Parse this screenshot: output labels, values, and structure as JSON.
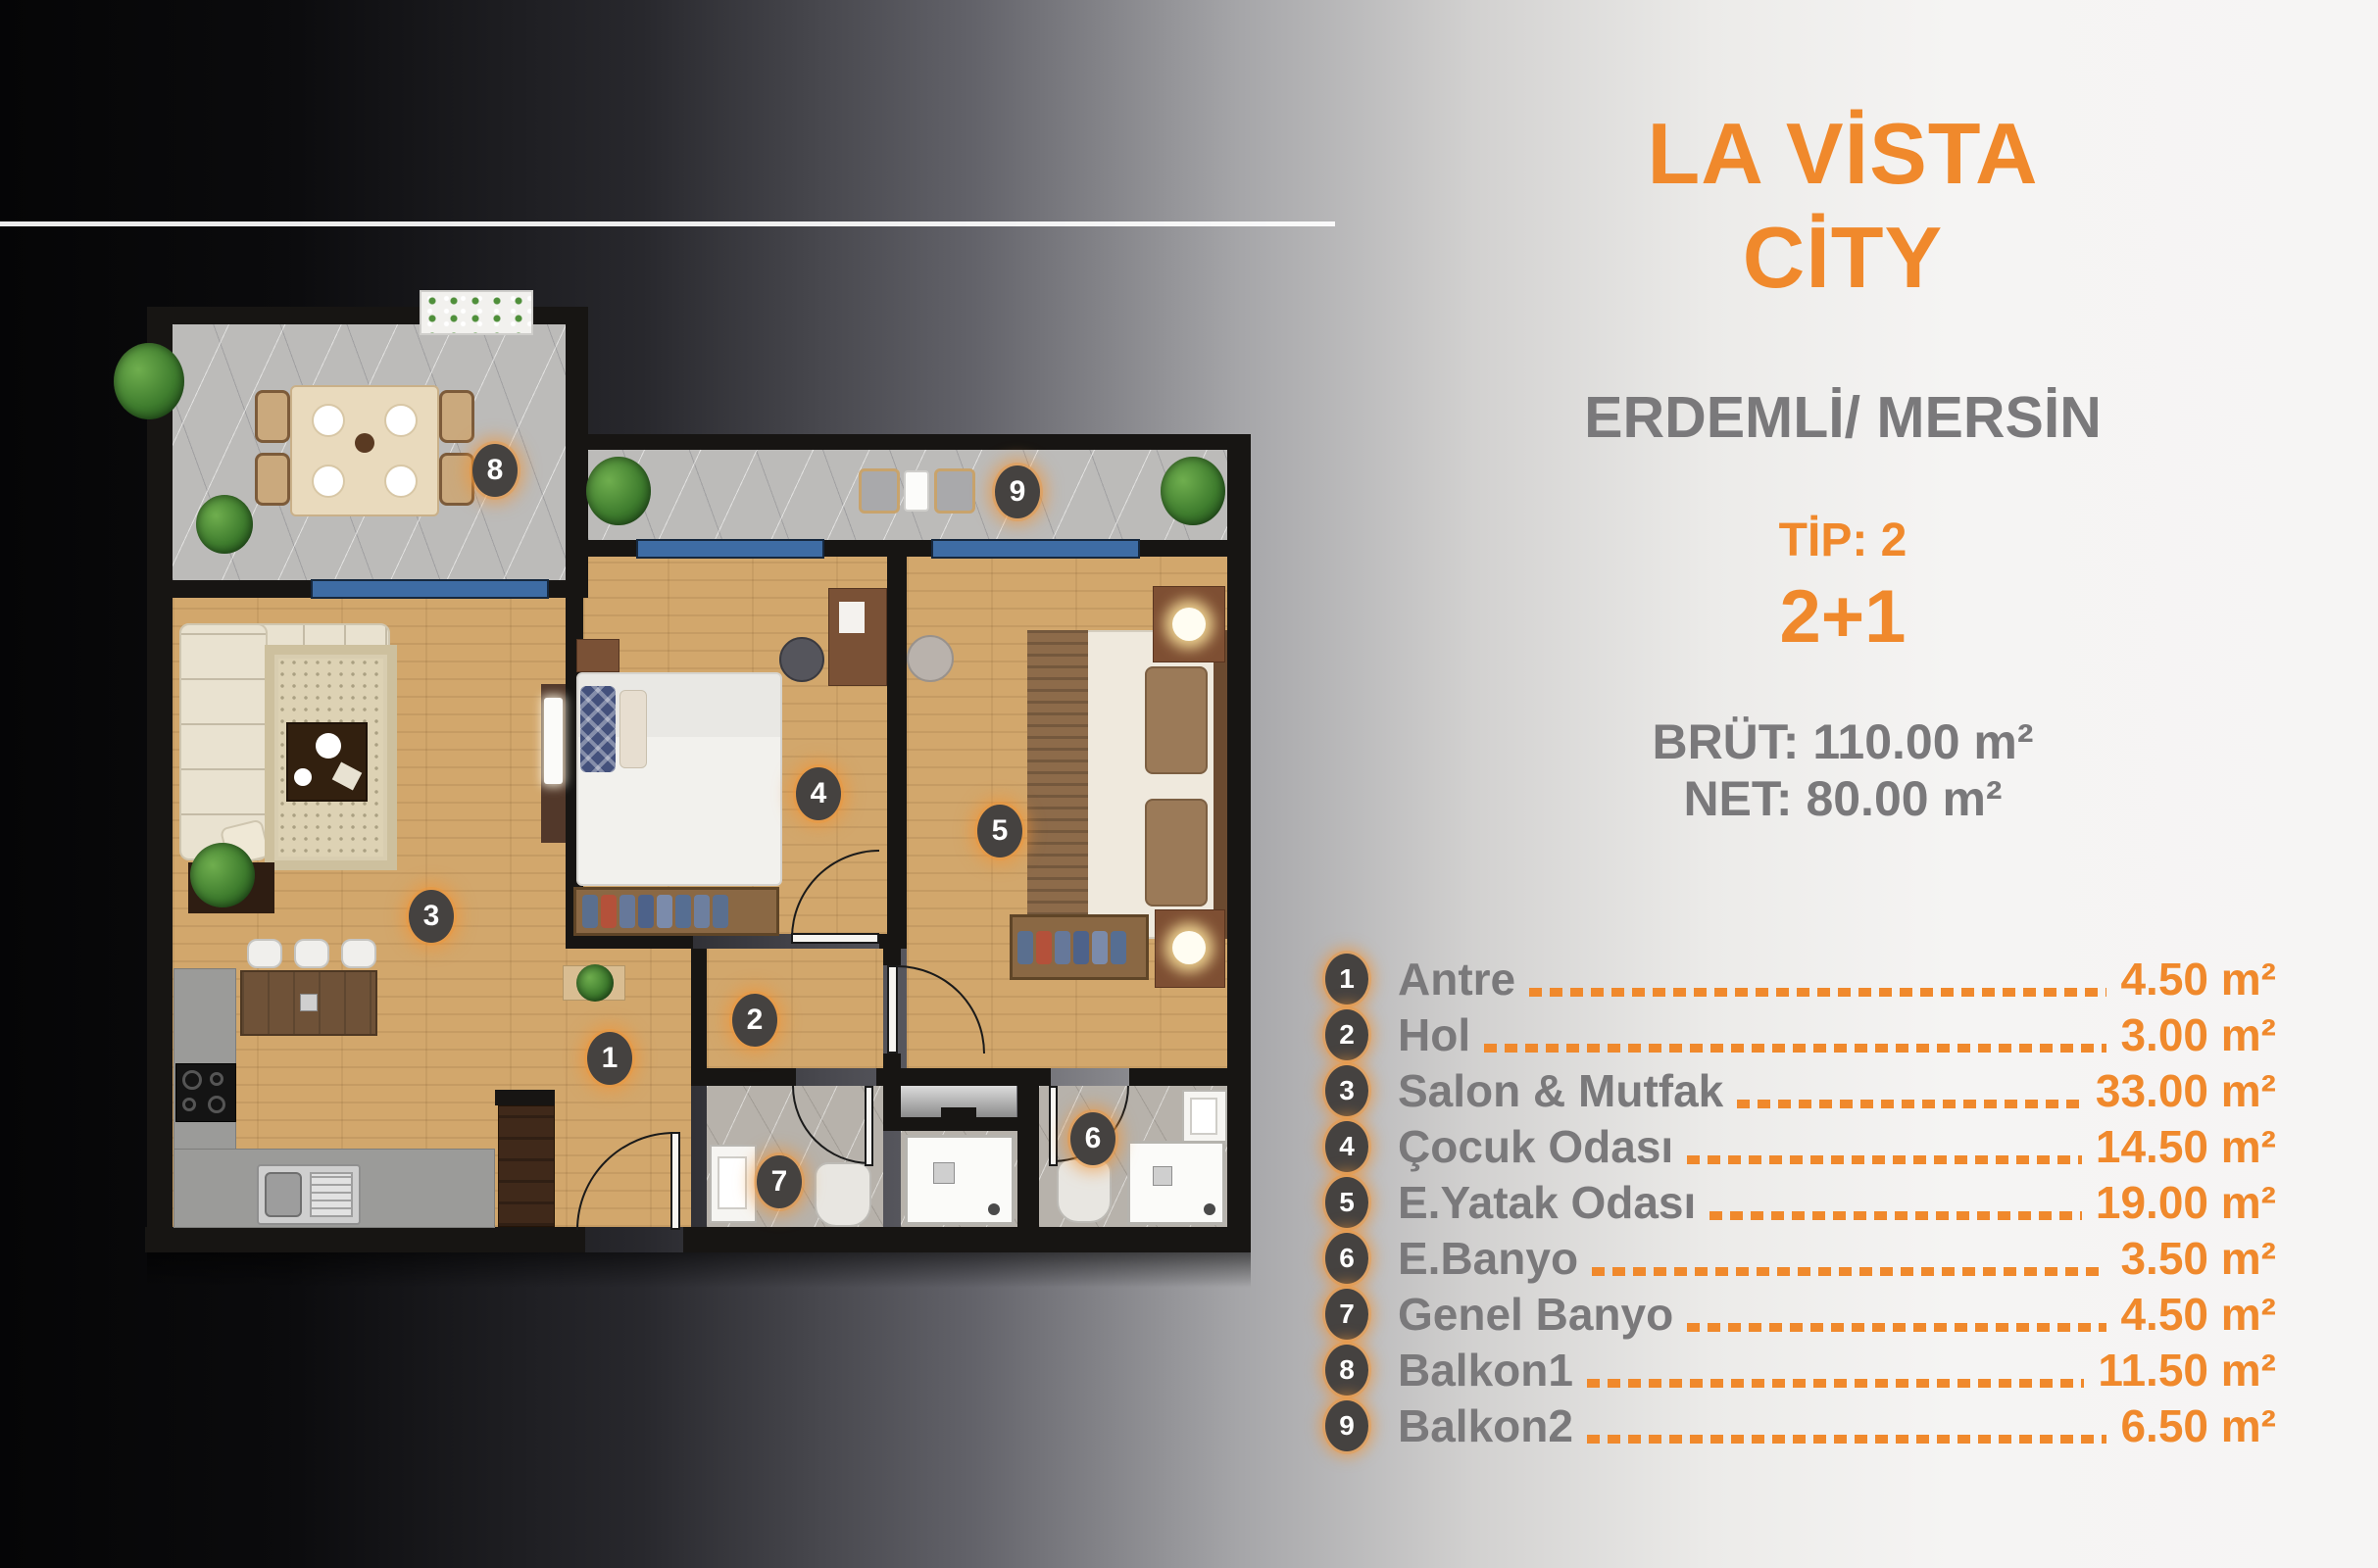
{
  "header": {
    "title_line1": "LA VİSTA",
    "title_line2": "CİTY",
    "subtitle": "ERDEMLİ/ MERSİN",
    "tip": "TİP: 2",
    "layout": "2+1",
    "brut": "BRÜT: 110.00 m²",
    "net": "NET: 80.00 m²"
  },
  "legend": {
    "rows": [
      {
        "num": "1",
        "name": "Antre",
        "value": "4.50 m²"
      },
      {
        "num": "2",
        "name": "Hol",
        "value": "3.00 m²"
      },
      {
        "num": "3",
        "name": "Salon & Mutfak",
        "value": "33.00 m²"
      },
      {
        "num": "4",
        "name": "Çocuk Odası",
        "value": "14.50 m²"
      },
      {
        "num": "5",
        "name": "E.Yatak Odası",
        "value": "19.00 m²"
      },
      {
        "num": "6",
        "name": "E.Banyo",
        "value": "3.50 m²"
      },
      {
        "num": "7",
        "name": "Genel Banyo",
        "value": "4.50 m²"
      },
      {
        "num": "8",
        "name": "Balkon1",
        "value": "11.50 m²"
      },
      {
        "num": "9",
        "name": "Balkon2",
        "value": "6.50 m²"
      }
    ]
  },
  "plan": {
    "badges": [
      "1",
      "2",
      "3",
      "4",
      "5",
      "6",
      "7",
      "8",
      "9"
    ]
  },
  "colors": {
    "accent": "#F0892C",
    "text_gray": "#7A797B",
    "wall": "#171513",
    "wood_floor": "#D2A76C",
    "marble": "#BCBBB9",
    "window_blue": "#3E6CA4",
    "badge_bg": "#454240"
  }
}
